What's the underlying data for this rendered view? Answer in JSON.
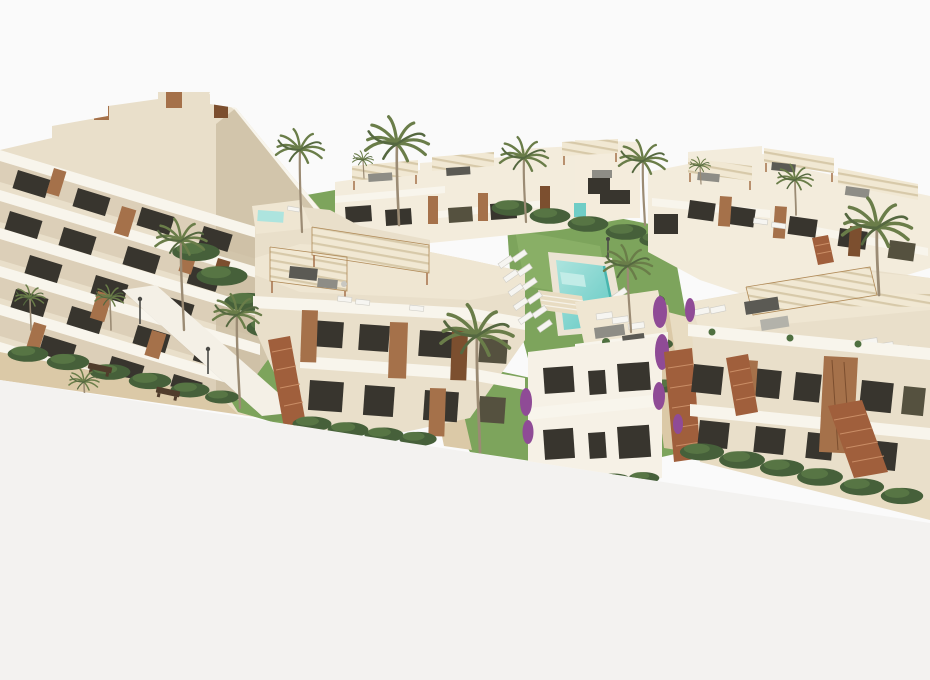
{
  "meta": {
    "type": "architectural-3d-render",
    "description": "Aerial 3D rendering of a new-build Mediterranean residential complex: white and cream apartment blocks with wooden accents, rooftop terraces with striped pergolas, exterior terracotta staircases, landscaped gardens with palm trees and hedges, sandy walkways with benches, and a turquoise swimming pool with rows of white sun loungers, all on a blank white backdrop cropped diagonally at the bottom."
  },
  "palette": {
    "background": "#fafafa",
    "lower_canvas": "#f3f2f0",
    "wall_light": "#f3ecdc",
    "wall_mid": "#e9dfca",
    "wall_dark": "#d2c5ab",
    "villa_white": "#f6f1e6",
    "deck": "#efe6d2",
    "slab_white": "#f8f5ec",
    "window_dark": "#38352e",
    "wood": "#a5714a",
    "wood_dark": "#7c4f2f",
    "stair_terracotta": "#a05f3c",
    "grass": "#7da45c",
    "grass_dark": "#628948",
    "hedge": "#46603a",
    "hedge_light": "#5b7a47",
    "palm_frond": "#6a7d49",
    "palm_frond_dark": "#556840",
    "palm_trunk": "#9b8b74",
    "sand": "#dbc9a7",
    "sand_light": "#e8dcc2",
    "pool_water": "#6fcdc6",
    "pool_water_light": "#ade4de",
    "pool_deck": "#ece4d4",
    "canopy": "#f1e8d3",
    "canopy_stripe": "#d7c9a9",
    "awning": "#f4f0e6",
    "furniture_gray": "#8e8d86",
    "lounger_white": "#f6f5f1",
    "flower_purple": "#8f4b96",
    "bench_brown": "#503c2b"
  },
  "scene": {
    "objects": [
      {
        "name": "left-terraced-building",
        "label": "Stepped terraced apartment block with wood panels"
      },
      {
        "name": "rear-center-building",
        "label": "Rear apartment row with rooftop pergolas"
      },
      {
        "name": "center-front-building",
        "label": "Central apartment block with pergola roof terraces"
      },
      {
        "name": "front-white-villa",
        "label": "Front white two-storey building with roof terrace"
      },
      {
        "name": "rear-right-building",
        "label": "Rear right apartment row"
      },
      {
        "name": "front-right-building",
        "label": "Front right apartments with exterior stairs"
      },
      {
        "name": "swimming-pool",
        "label": "Turquoise communal swimming pool"
      },
      {
        "name": "sun-loungers",
        "label": "White sun loungers beside the pool"
      },
      {
        "name": "central-lawn",
        "label": "Communal garden lawn"
      },
      {
        "name": "walkway",
        "label": "Sandy pedestrian walkway with shade sail"
      },
      {
        "name": "benches",
        "label": "Wooden benches"
      },
      {
        "name": "palm-trees",
        "label": "Palm trees"
      },
      {
        "name": "hedges",
        "label": "Clipped green hedges"
      }
    ]
  }
}
